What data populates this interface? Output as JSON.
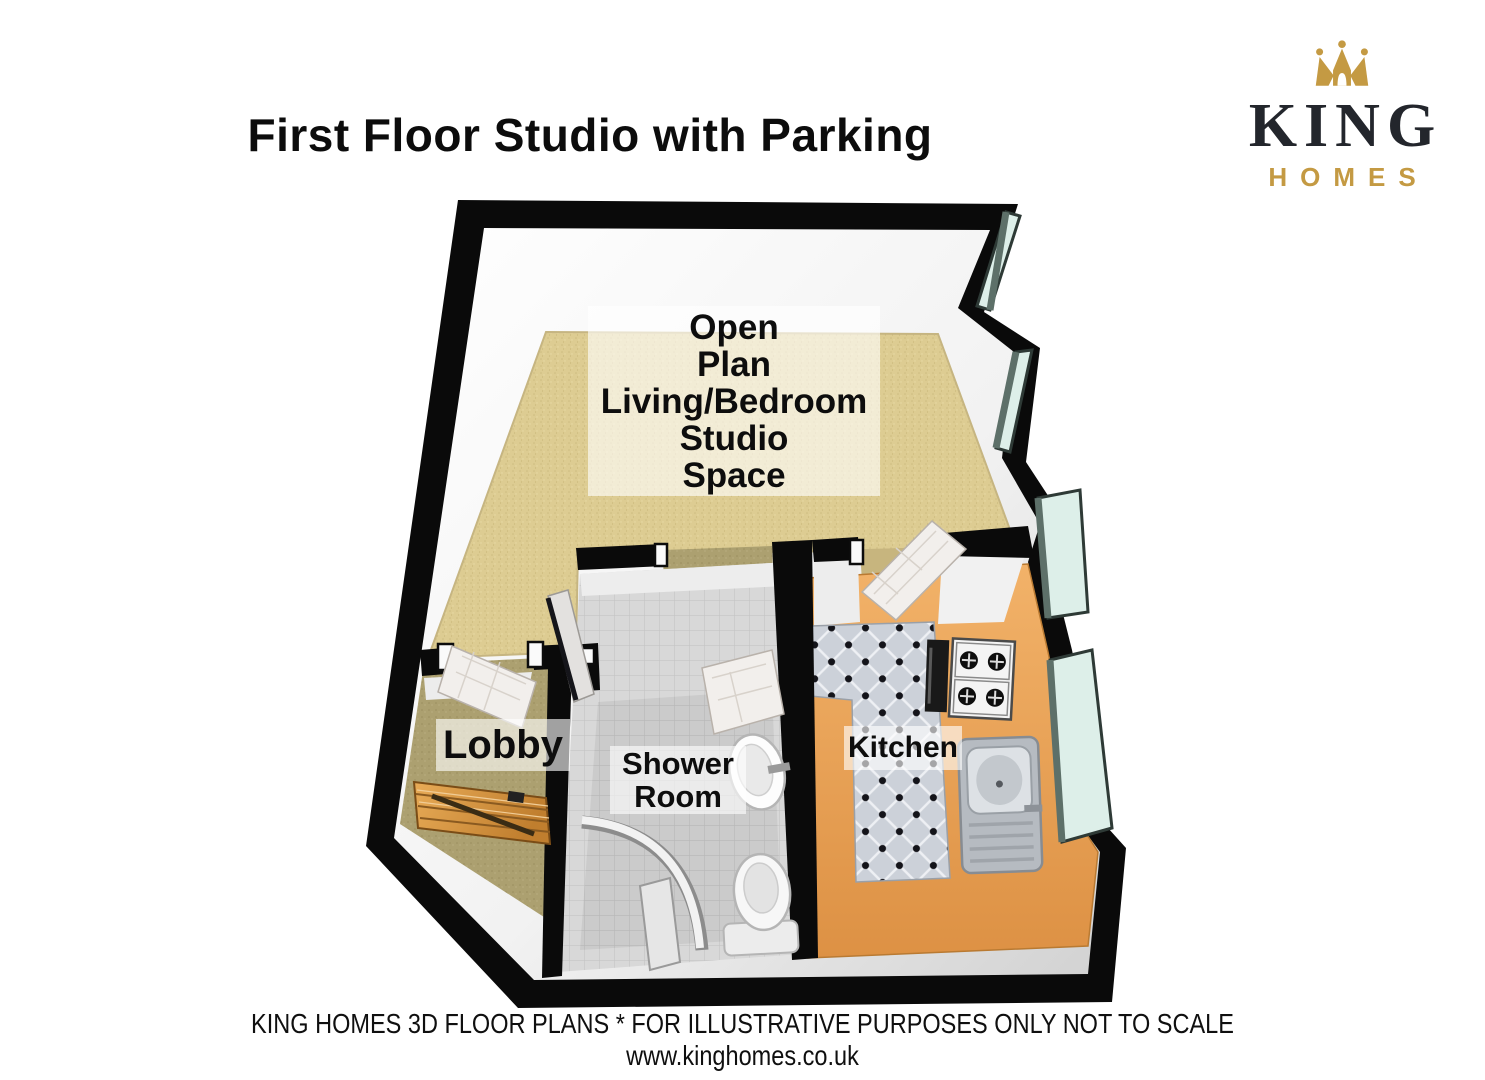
{
  "title": "First Floor Studio with Parking",
  "logo": {
    "brand": "KING",
    "sub_brand": "HOMES",
    "crown_icon": "crown-icon",
    "gold_color": "#c49a43",
    "dark_color": "#23262c"
  },
  "floor_plan": {
    "rooms": {
      "open_plan": {
        "lines": [
          "Open",
          "Plan",
          "Living/Bedroom",
          "Studio",
          "Space"
        ]
      },
      "lobby": {
        "lines": [
          "Lobby"
        ]
      },
      "shower_room": {
        "lines": [
          "Shower",
          "Room"
        ]
      },
      "kitchen": {
        "lines": [
          "Kitchen"
        ]
      }
    },
    "fixtures": [
      "staircase",
      "entrance-door",
      "internal-doors",
      "shower-enclosure",
      "pedestal-sink",
      "toilet",
      "kitchen-sink",
      "gas-hob",
      "oven",
      "worktop",
      "bay-windows"
    ],
    "colors": {
      "exterior_wall": "#0a0a0a",
      "wall_face": "#f5f5f5",
      "carpet": "#ddcc92",
      "lobby_floor": "#aca070",
      "shower_tile": "#d7d7d7",
      "kitchen_tile": "#ccd1d9",
      "worktop": "#e9a458",
      "window_glass": "#ddefe9",
      "stairs_wood": "#d18f3e",
      "label_background": "rgba(255,255,255,0.62)",
      "text": "#111111"
    }
  },
  "footer": {
    "line1": "KING HOMES 3D FLOOR PLANS * FOR ILLUSTRATIVE PURPOSES ONLY NOT TO SCALE",
    "line2": "www.kinghomes.co.uk"
  }
}
